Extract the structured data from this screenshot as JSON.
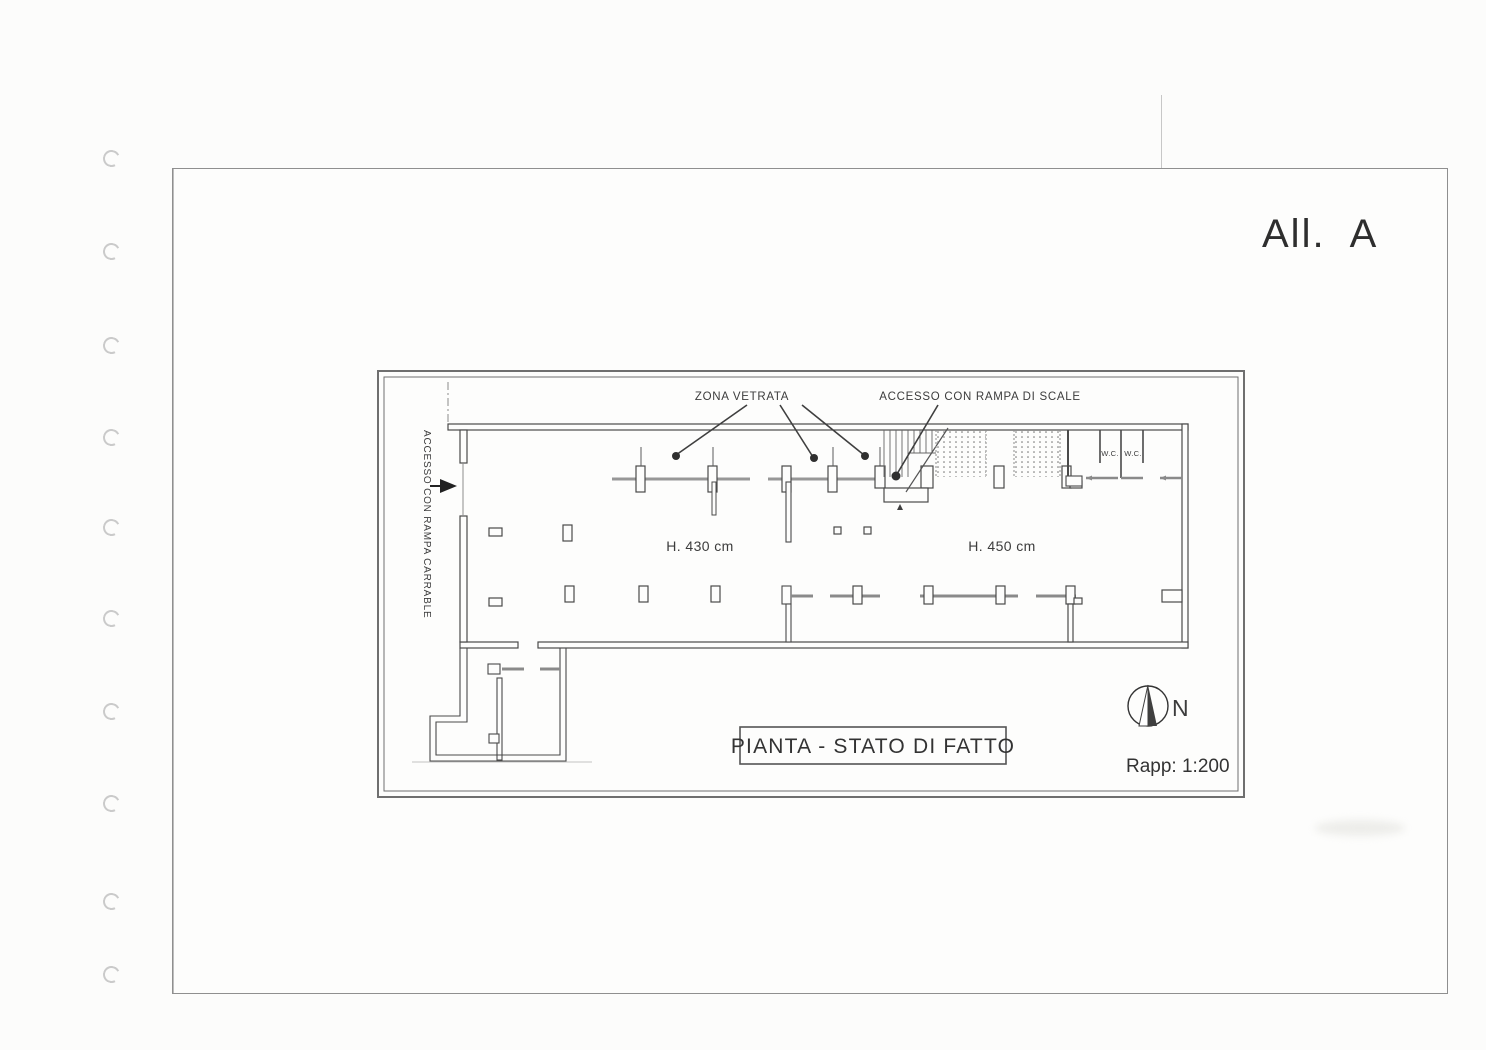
{
  "document": {
    "attachment_label": "All.  A",
    "title_box_label": "PIANTA - STATO DI FATTO",
    "scale_label": "Rapp: 1:200",
    "north_label": "N"
  },
  "plan_labels": {
    "glazed_zone": "ZONA VETRATA",
    "stair_access": "ACCESSO CON RAMPA DI SCALE",
    "driveway_access": "ACCESSO CON RAMPA CARRABLE",
    "height_left_room": "H. 430 cm",
    "height_right_room": "H. 450 cm",
    "wc_left": "W.C.",
    "wc_right": "W.C."
  },
  "colors": {
    "ink": "#3f3f3f",
    "wall_dark": "#4a4a4a",
    "wall_gray": "#979797",
    "frame": "#6f6f6f",
    "paper": "#fdfdfc"
  }
}
